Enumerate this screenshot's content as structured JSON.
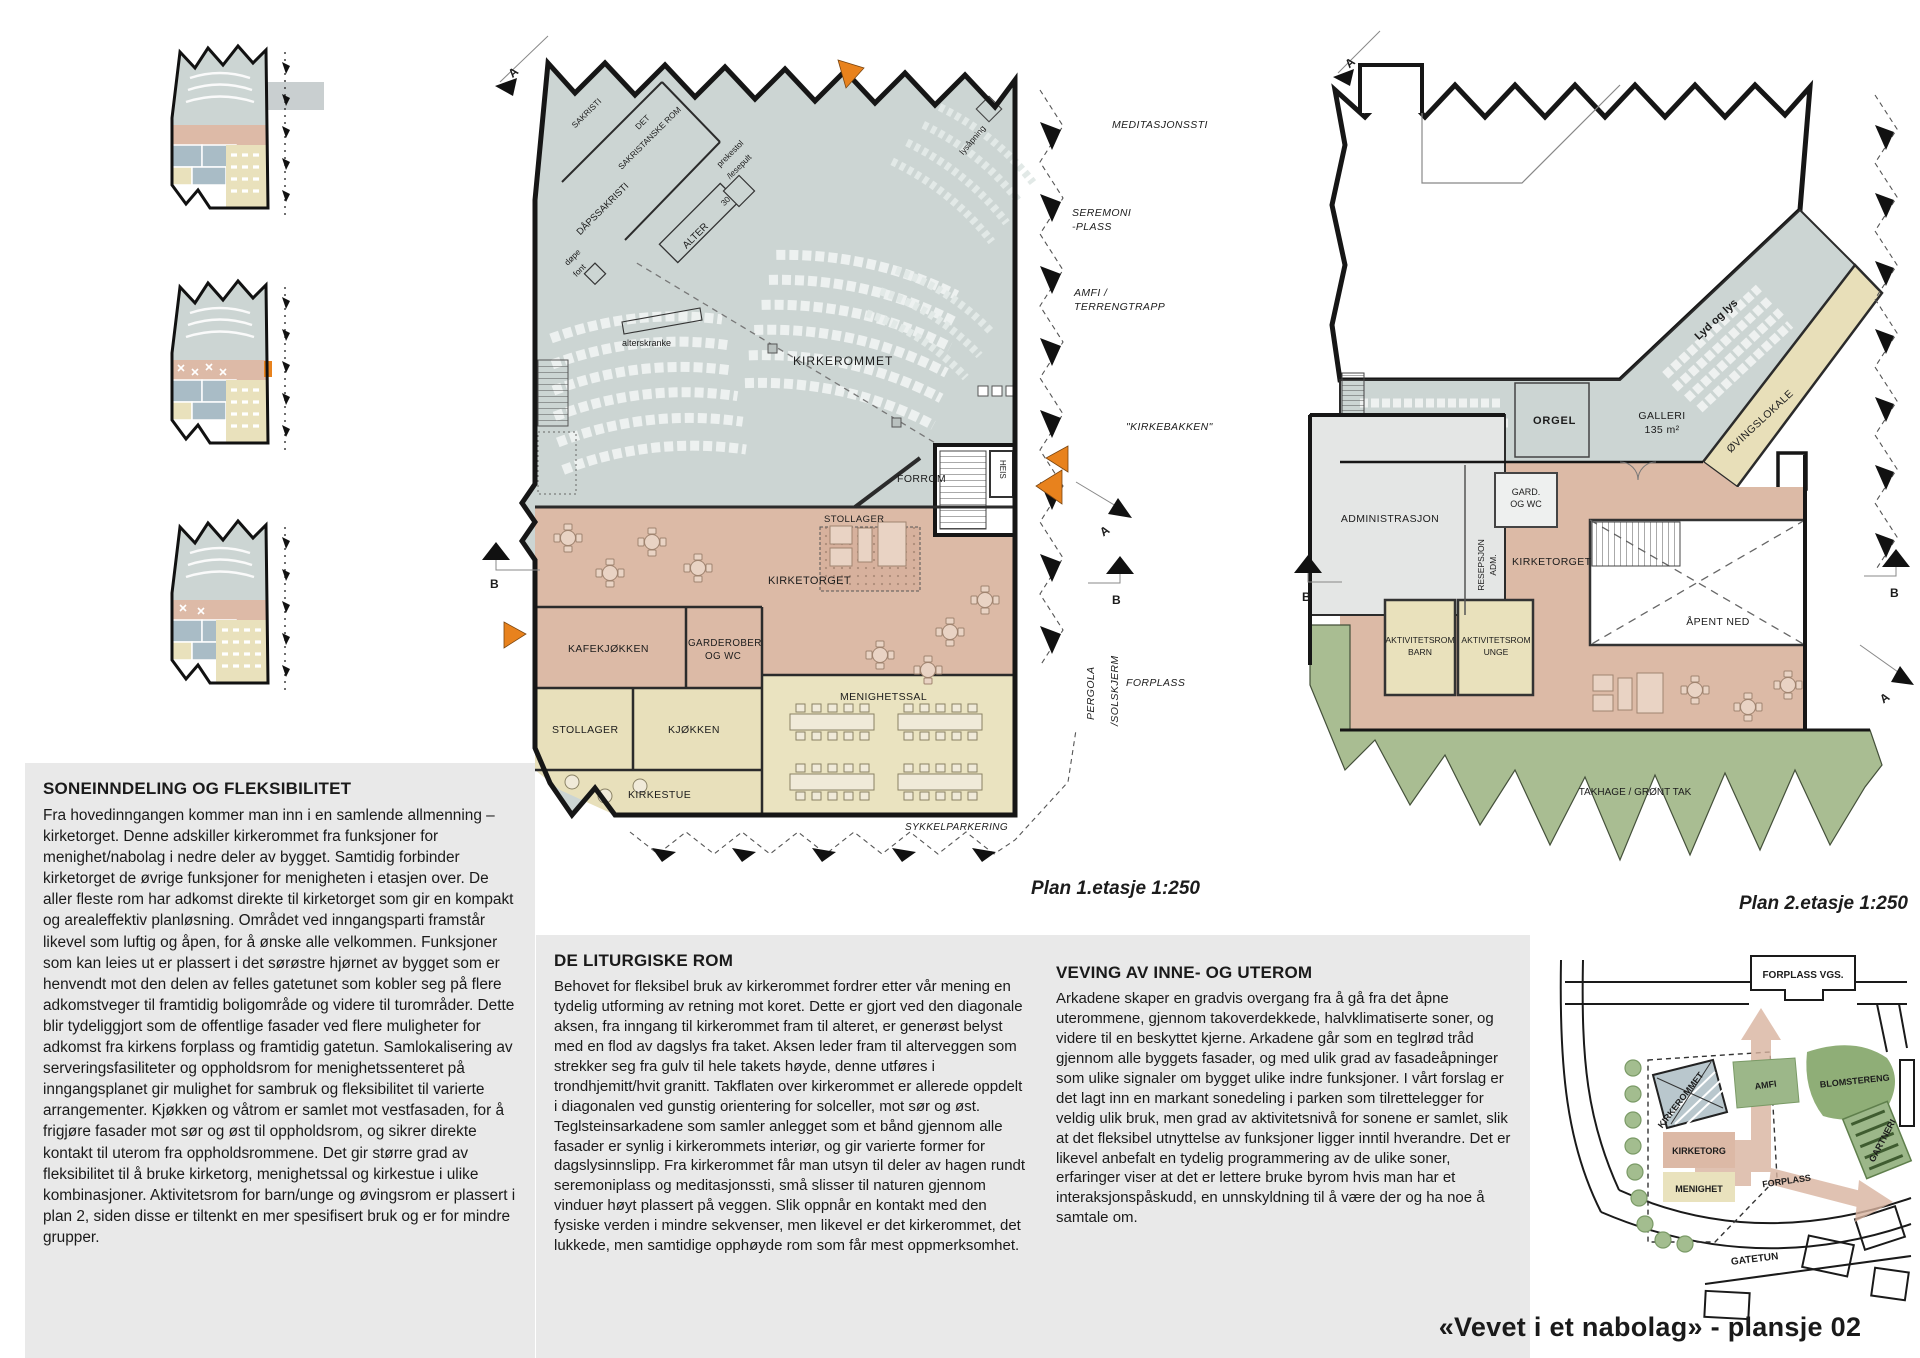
{
  "page": {
    "title": "«Vevet i et nabolag» - plansje 02"
  },
  "plan1": {
    "caption": "Plan 1.etasje 1:250",
    "rooms": {
      "sakristi": "SAKRISTI",
      "sakristanske_1": "DET",
      "sakristanske_2": "SAKRISTANSKE ROM",
      "dapssakristi": "DÅPSSAKRISTI",
      "alter": "ALTER",
      "alter_nr": "30",
      "prekestol_1": "prekestol",
      "prekestol_2": "/lesepult",
      "dopefont_1": "døpe",
      "dopefont_2": "font",
      "alterskranke": "alterskranke",
      "kirkerommet": "KIRKEROMMET",
      "lysapning": "lysåpning",
      "forrom": "FORROM",
      "heis": "HEIS",
      "stollager_oppe": "STOLLAGER",
      "kirketorget": "KIRKETORGET",
      "kafekjokken": "KAFEKJØKKEN",
      "garderober_1": "GARDEROBER",
      "garderober_2": "OG WC",
      "stollager": "STOLLAGER",
      "kjokken": "KJØKKEN",
      "kirkestue": "KIRKESTUE",
      "menighetssal": "MENIGHETSSAL"
    },
    "site": {
      "meditasjonssti": "MEDITASJONSSTI",
      "seremoni_1": "SEREMONI",
      "seremoni_2": "-PLASS",
      "amfi_1": "AMFI /",
      "amfi_2": "TERRENGTRAPP",
      "kirkebakken": "\"KIRKEBAKKEN\"",
      "forplass": "FORPLASS",
      "pergola_1": "PERGOLA",
      "pergola_2": "/SOLSKJERM",
      "sykkelparkering": "SYKKELPARKERING"
    },
    "markers": {
      "a": "A",
      "b": "B"
    }
  },
  "plan2": {
    "caption": "Plan 2.etasje 1:250",
    "rooms": {
      "lyd_og_lys": "Lyd og lys",
      "orgel": "ORGEL",
      "galleri_1": "GALLERI",
      "galleri_2": "135 m²",
      "ovingslokale": "ØVINGSLOKALE",
      "gard_1": "GARD.",
      "gard_2": "OG WC",
      "administrasjon": "ADMINISTRASJON",
      "resepsjon_1": "RESEPSJON",
      "resepsjon_2": "ADM.",
      "kirketorget": "KIRKETORGET",
      "apent_ned": "ÅPENT NED",
      "akt_barn_1": "AKTIVITETSROM",
      "akt_barn_2": "BARN",
      "akt_unge_1": "AKTIVITETSROM",
      "akt_unge_2": "UNGE",
      "takhage": "TAKHAGE / GRØNT TAK"
    },
    "markers": {
      "a": "A",
      "b": "B"
    }
  },
  "texts": {
    "soneinndeling": {
      "title": "SONEINNDELING OG FLEKSIBILITET",
      "body": "Fra hovedinngangen kommer man inn i en samlende allmenning – kirketorget. Denne adskiller kirkerommet fra funksjoner for menighet/nabolag i nedre deler av bygget. Samtidig forbinder kirketorget de øvrige funksjoner for menigheten i etasjen over. De aller fleste rom har adkomst direkte til kirketorget som gir en kompakt og arealeffektiv planløsning. Området ved inngangsparti framstår likevel som luftig og åpen, for å ønske alle velkommen. Funksjoner som kan leies ut er plassert i det sørøstre hjørnet av bygget som er henvendt mot den delen av felles gatetunet som kobler seg på flere adkomstveger til framtidig boligområde og videre til turområder. Dette blir tydeliggjort som de offentlige fasader ved flere muligheter for adkomst fra kirkens forplass og framtidig gatetun. Samlokalisering av serveringsfasiliteter og oppholdsrom for menighetssenteret på inngangsplanet gir mulighet for sambruk og fleksibilitet til varierte arrangementer. Kjøkken og våtrom er samlet mot vestfasaden, for å frigjøre fasader mot sør og øst til oppholdsrom, og sikrer direkte kontakt til uterom fra oppholdsrommene. Det gir større grad av fleksibilitet til å bruke kirketorg, menighetssal og kirkestue i ulike kombinasjoner. Aktivitetsrom for barn/unge og øvingsrom er plassert i plan 2, siden disse er tiltenkt en mer spesifisert bruk og er for mindre grupper."
    },
    "liturgiske": {
      "title": "DE LITURGISKE ROM",
      "body": "Behovet for fleksibel bruk av kirkerommet fordrer etter vår mening en tydelig utforming av retning mot koret. Dette er gjort ved den diagonale aksen, fra inngang til kirkerommet fram til alteret, er generøst belyst med en flod av dagslys fra taket. Aksen leder fram til alterveggen som strekker seg fra gulv til hele takets høyde, denne utføres i trondhjemitt/hvit granitt. Takflaten over kirkerommet er allerede oppdelt i diagonalen ved gunstig orientering for solceller, mot sør og øst. Teglsteinsarkadene som samler anlegget som et bånd gjennom alle fasader er synlig i kirkerommets interiør, og gir varierte former for dagslysinnslipp. Fra kirkerommet får man utsyn til deler av hagen rundt seremoniplass og meditasjonssti, små slisser til naturen gjennom vinduer høyt plassert på veggen. Slik oppnår en kontakt med den fysiske verden i mindre sekvenser, men likevel er det kirkerommet, det lukkede, men samtidige opphøyde rom som får mest oppmerksomhet."
    },
    "veving": {
      "title": "VEVING AV INNE- OG UTEROM",
      "body": "Arkadene skaper en gradvis overgang fra å gå fra det åpne uterommene, gjennom takoverdekkede, halvklimatiserte soner, og videre til en beskyttet kjerne. Arkadene går som en tegl­rød tråd gjennom alle byggets fasader, og med ulik grad av fasadeåpninger som ulike signaler om bygget ulike indre funksjoner. I vårt forslag er det lagt inn en markant sonedeling i parken som tilrettelegger for veldig ulik bruk, men grad av aktivitetsnivå for sonene er samlet, slik at det fleksibel utnyttelse av funksjoner ligger inntil hverandre. Det er likevel anbefalt en tydelig programmering av de ulike soner, erfaringer viser at det er lettere bruke byrom hvis man har et interaksjonspåskudd, en unnskyldning til å være der og ha noe å samtale om."
    }
  },
  "siteplan": {
    "labels": {
      "forplass_vgs": "FORPLASS VGS.",
      "blomstereng": "BLOMSTERENG",
      "amfi": "AMFI",
      "gartneri": "GARTNERI",
      "kirkerommet": "KIRKEROMMET",
      "kirketorg": "KIRKETORG",
      "menighet": "MENIGHET",
      "forplass": "FORPLASS",
      "gatetun": "GATETUN"
    }
  },
  "colors": {
    "hall_blue": "#ccd5d3",
    "rose": "#dcbaa6",
    "beige": "#e8e0bb",
    "admin_grey": "#e4e6e5",
    "green": "#a9bd92",
    "orange": "#e8821d",
    "panel": "#e9e9e9"
  }
}
